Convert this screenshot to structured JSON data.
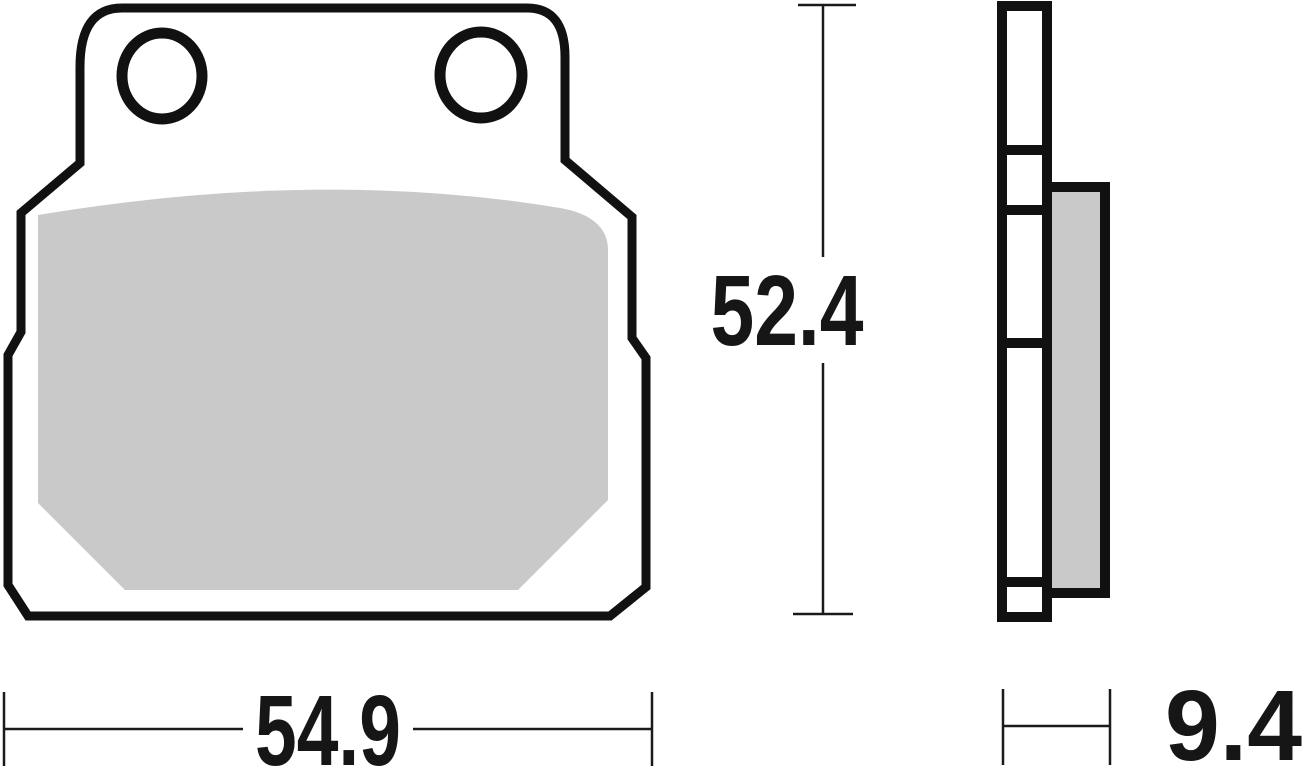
{
  "drawing": {
    "dimensions": {
      "width": "54.9",
      "height": "52.4",
      "thickness": "9.4"
    },
    "colors": {
      "outline": "#111111",
      "friction_material": "#c9c9c9",
      "background": "#ffffff"
    }
  }
}
